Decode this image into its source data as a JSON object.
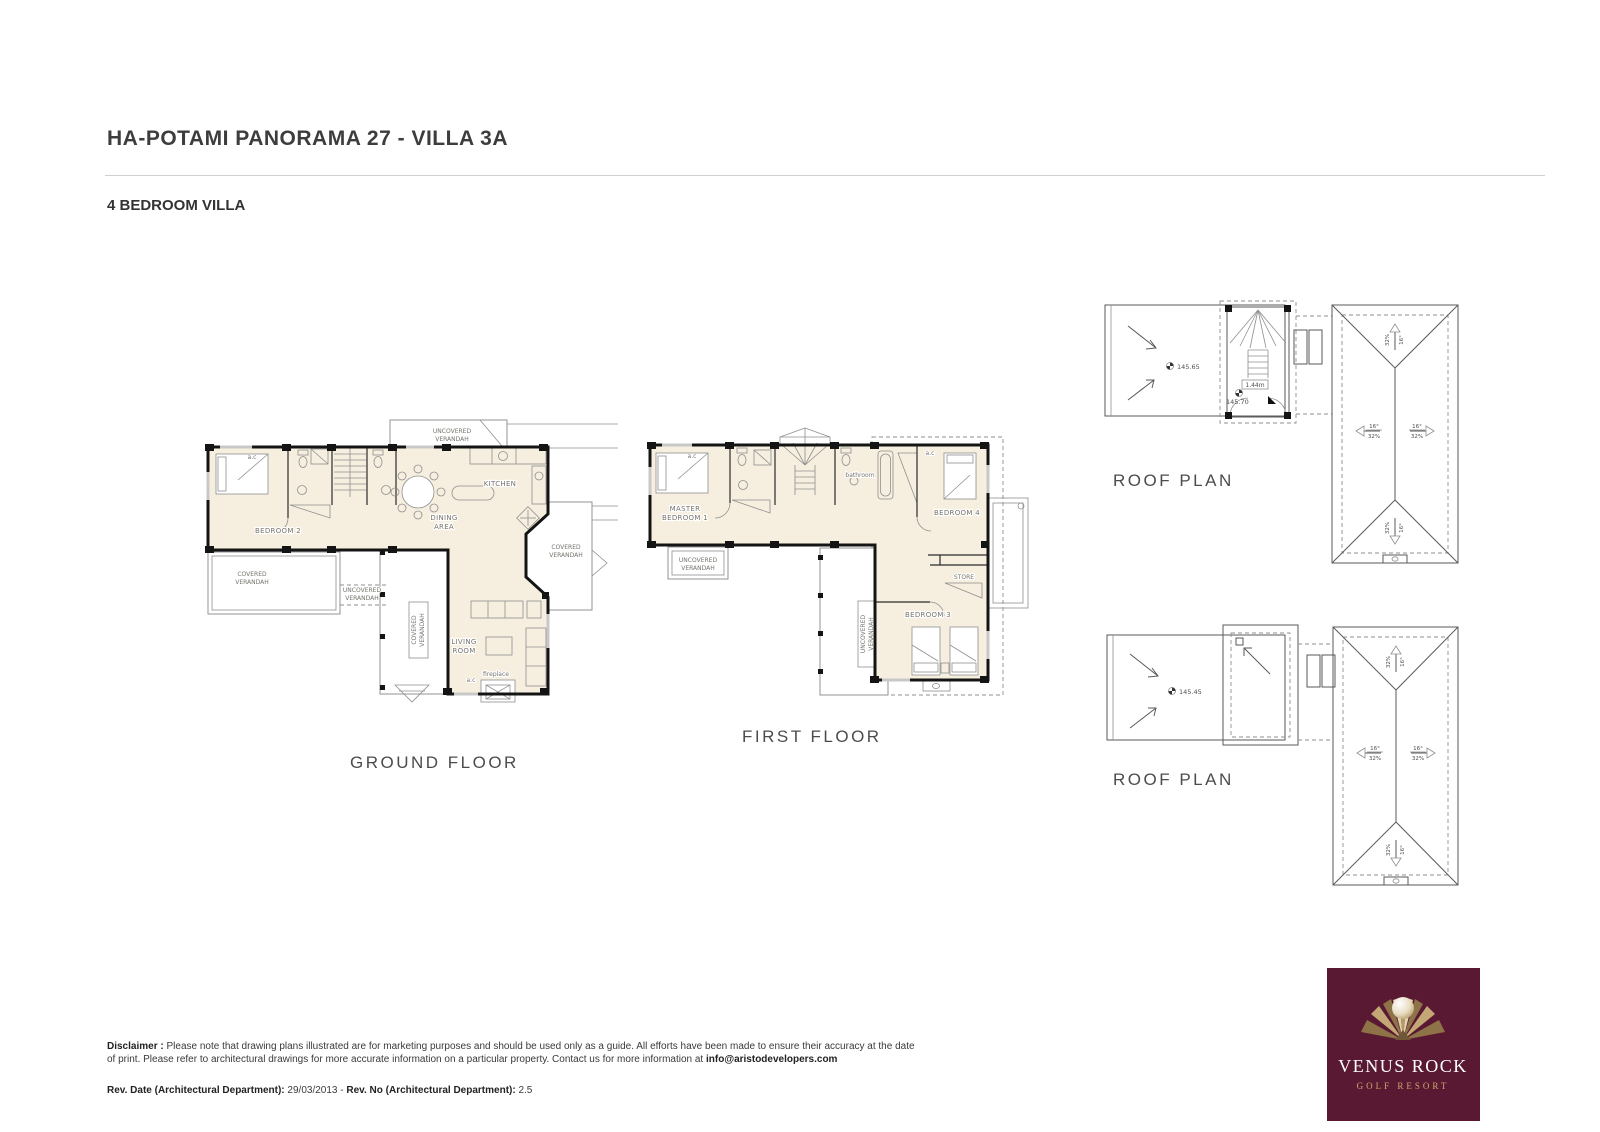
{
  "header": {
    "title": "HA-POTAMI PANORAMA 27 - VILLA 3A",
    "subtitle": "4 BEDROOM VILLA"
  },
  "ground_floor": {
    "caption": "GROUND FLOOR",
    "labels": {
      "uncovered_top_1": "UNCOVERED",
      "uncovered_top_2": "VERANDAH",
      "ac": "a.c",
      "bedroom2": "BEDROOM 2",
      "kitchen": "KITCHEN",
      "dining_1": "DINING",
      "dining_2": "AREA",
      "covered_left_1": "COVERED",
      "covered_left_2": "VERANDAH",
      "uncovered_mid_1": "UNCOVERED",
      "uncovered_mid_2": "VERANDAH",
      "covered_vert_1": "COVERED",
      "covered_vert_2": "VERANDAH",
      "covered_right_1": "COVERED",
      "covered_right_2": "VERANDAH",
      "living_1": "LIVING",
      "living_2": "ROOM",
      "fireplace": "fireplace"
    }
  },
  "first_floor": {
    "caption": "FIRST FLOOR",
    "labels": {
      "ac": "a.c",
      "master_1": "MASTER",
      "master_2": "BEDROOM 1",
      "bathroom": "bathroom",
      "bedroom4": "BEDROOM 4",
      "store": "STORE",
      "bedroom3": "BEDROOM 3",
      "uncovered_left_1": "UNCOVERED",
      "uncovered_left_2": "VERANDAH",
      "uncovered_vert_1": "UNCOVERED",
      "uncovered_vert_2": "VERANDAH"
    }
  },
  "roof_plan_upper": {
    "caption": "ROOF PLAN",
    "pergola_level": "145.65",
    "stair_width": "1.44m",
    "landing_level": "145.70",
    "slope_deg": "16°",
    "slope_pct": "32%"
  },
  "roof_plan_lower": {
    "caption": "ROOF PLAN",
    "pergola_level": "145.45",
    "slope_deg": "16°",
    "slope_pct": "32%"
  },
  "footer": {
    "disclaimer_label": "Disclaimer :",
    "disclaimer_line1": "Please note that drawing plans illustrated are for marketing purposes and should be used only as a guide. All efforts have been made to ensure their accuracy at the date of print.",
    "disclaimer_line2": "Please refer to architectural drawings for more accurate information on a particular property. Contact us for more information at ",
    "disclaimer_email": "info@aristodevelopers.com",
    "rev_date_label": "Rev. Date (Architectural Department):",
    "rev_date_value": "29/03/2013",
    "rev_separator": "-",
    "rev_no_label": "Rev. No (Architectural Department):",
    "rev_no_value": "2.5"
  },
  "logo": {
    "name": "VENUS ROCK",
    "tagline": "GOLF RESORT",
    "bg_color": "#5a1932",
    "gold_color": "#caa96e"
  }
}
